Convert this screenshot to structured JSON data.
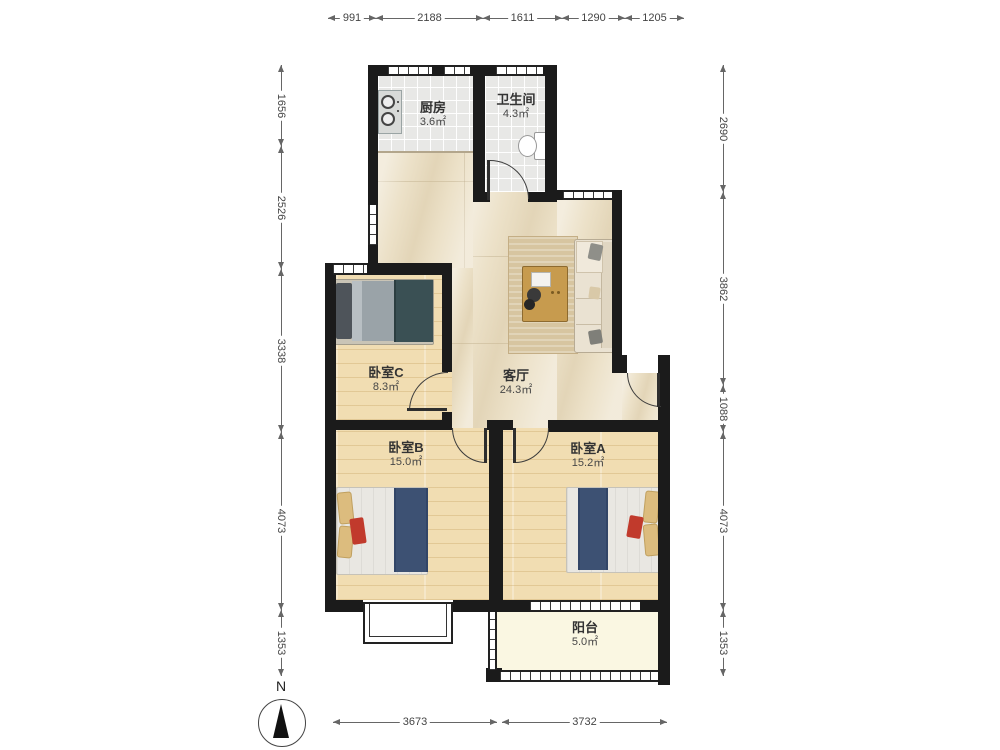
{
  "plan": {
    "rooms": [
      {
        "id": "kitchen",
        "name": "厨房",
        "area": "3.6㎡"
      },
      {
        "id": "bathroom",
        "name": "卫生间",
        "area": "4.3㎡"
      },
      {
        "id": "bedroom-c",
        "name": "卧室C",
        "area": "8.3㎡"
      },
      {
        "id": "living-room",
        "name": "客厅",
        "area": "24.3㎡"
      },
      {
        "id": "bedroom-b",
        "name": "卧室B",
        "area": "15.0㎡"
      },
      {
        "id": "bedroom-a",
        "name": "卧室A",
        "area": "15.2㎡"
      },
      {
        "id": "balcony",
        "name": "阳台",
        "area": "5.0㎡"
      }
    ],
    "compass_label": "N"
  },
  "dimensions": {
    "top": [
      "991",
      "2188",
      "1611",
      "1290",
      "1205"
    ],
    "left": [
      "1656",
      "2526",
      "3338",
      "4073",
      "1353"
    ],
    "right": [
      "2690",
      "3862",
      "1088",
      "4073",
      "1353"
    ],
    "bottom": [
      "3673",
      "3732"
    ]
  },
  "colors": {
    "wall": "#1b1b1b",
    "marble_floor": "#ece1c8",
    "wood_floor": "#f1ddb2",
    "tile_floor": "#e8e8e6",
    "balcony_floor": "#faf7e2",
    "bed_runner_navy": "#3d5173",
    "duvet_teal": "#3a5054",
    "accent_red": "#c13a2c",
    "sofa_cream": "#eae2d2",
    "table_wood": "#c79b4e",
    "dimension_line": "#666666"
  }
}
